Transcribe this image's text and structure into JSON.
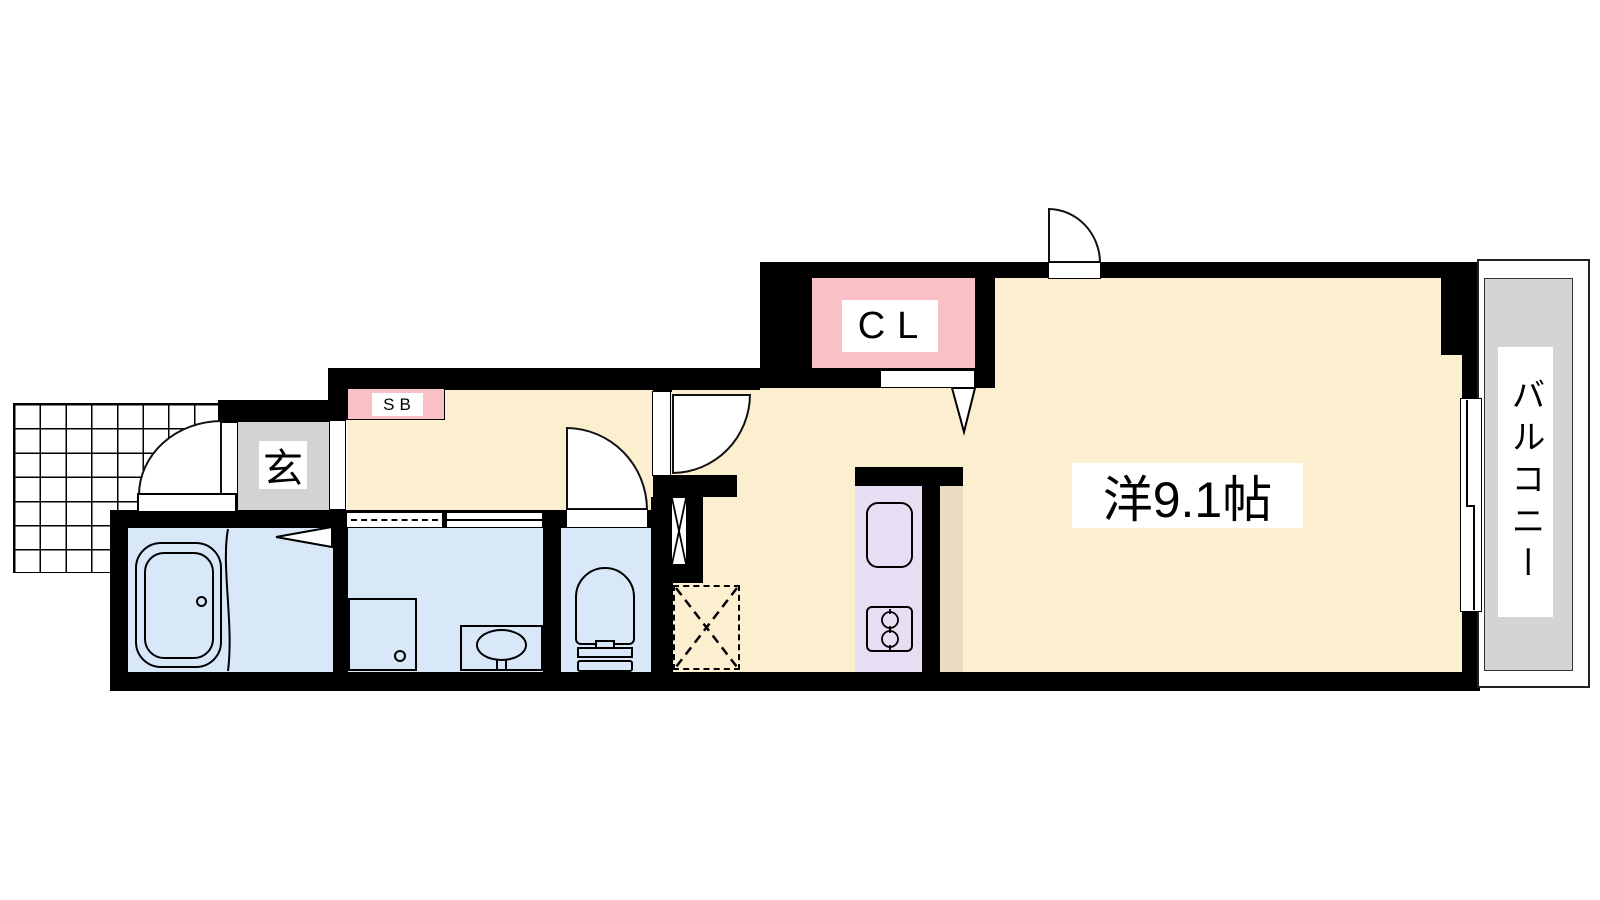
{
  "plan": {
    "type": "apartment-floor-plan",
    "rooms": {
      "entrance": {
        "label": "玄",
        "name": "genkan-entrance"
      },
      "shoe_box": {
        "label": "SB",
        "name": "shoe-box"
      },
      "closet": {
        "label": "CL",
        "name": "closet"
      },
      "western_room": {
        "label": "洋9.1帖",
        "name": "western-room-9.1-jo"
      },
      "balcony": {
        "label": "バルコニー",
        "name": "balcony"
      }
    },
    "fixtures": [
      "bathtub",
      "washing-machine-pan",
      "vanity-sink",
      "toilet",
      "kitchen-sink",
      "two-burner-stove",
      "refrigerator-space",
      "pipe-space"
    ],
    "colors": {
      "floor": "#FBEFD0",
      "wet": "#D9E8F8",
      "entrance": "#D3D3D3",
      "storage": "#F9C1C5",
      "kitchen": "#E8DEF4",
      "counter": "#EADCC1",
      "balcony": "#D4D4D4",
      "wall": "#000000"
    }
  }
}
